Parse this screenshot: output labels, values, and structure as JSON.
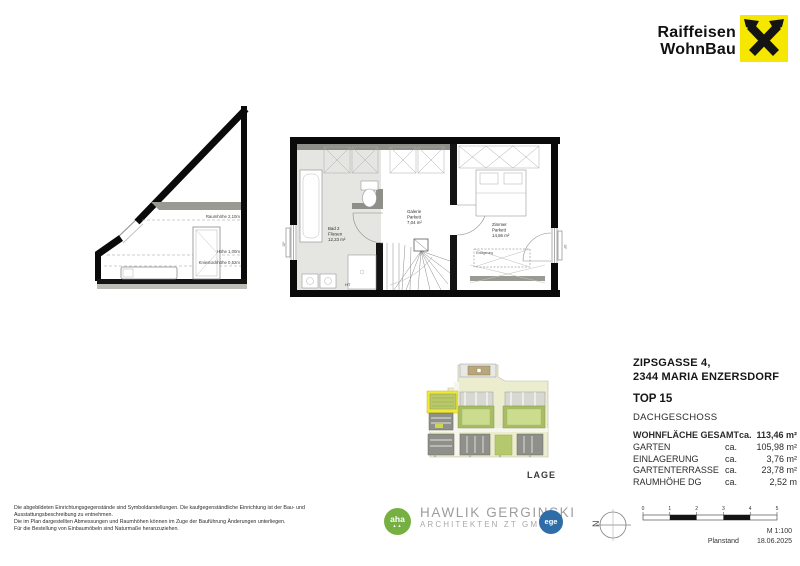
{
  "brand": {
    "name_line1": "Raiffeisen",
    "name_line2": "WohnBau"
  },
  "section_drawing": {
    "labels": {
      "room_height": "Raumhöhe 2,10m",
      "height": "Höhe 1,00m",
      "knee_wall": "Kniestockhöhe 0,52m"
    }
  },
  "floorplan": {
    "rooms": [
      {
        "name": "Bad 2",
        "finish": "Fliesen",
        "area": "12,23 m²"
      },
      {
        "name": "Galerie",
        "finish": "Parkett",
        "area": "7,04 m²"
      },
      {
        "name": "Zimmer",
        "finish": "Parkett",
        "area": "14,56 m²"
      }
    ],
    "labels": {
      "shaft": "HT",
      "storage": "Einlagerung",
      "window": "DF"
    }
  },
  "project": {
    "address_line1": "ZIPSGASSE 4,",
    "address_line2": "2344 MARIA ENZERSDORF",
    "unit": "TOP 15",
    "level": "DACHGESCHOSS",
    "areas": [
      {
        "label": "WOHNFLÄCHE GESAMT",
        "prefix": "ca.",
        "value": "113,46 m²"
      },
      {
        "label": "GARTEN",
        "prefix": "ca.",
        "value": "105,98 m²"
      },
      {
        "label": "EINLAGERUNG",
        "prefix": "ca.",
        "value": "3,76 m²"
      },
      {
        "label": "GARTENTERRASSE",
        "prefix": "ca.",
        "value": "23,78 m²"
      },
      {
        "label": "RAUMHÖHE DG",
        "prefix": "ca.",
        "value": "2,52 m"
      }
    ]
  },
  "siteplan": {
    "caption": "LAGE"
  },
  "footer": {
    "disclaimer": [
      "Die abgebildeten Einrichtungsgegenstände sind Symboldarstellungen. Die kaufgegenständliche Einrichtung ist der Bau- und",
      "Ausstattungsbeschreibung zu entnehmen.",
      "Die im Plan dargestellten Abmessungen und Raumhöhen können im Zuge der Bauführung Änderungen unterliegen.",
      "Für die Bestellung von Einbaumöbeln sind Naturmaße heranzuziehen."
    ],
    "architect": {
      "badge": "aha",
      "name": "HAWLIK GERGINSKI",
      "subtitle": "ARCHITEKTEN ZT GMBH",
      "partner_badge": "ege"
    },
    "north_label": "N",
    "scale": {
      "ticks": [
        "0",
        "1",
        "2",
        "3",
        "4",
        "5"
      ],
      "ratio": "M 1:100",
      "status_label": "Planstand",
      "date": "18.06.2025"
    }
  },
  "colors": {
    "brand_yellow": "#f6e700",
    "highlight_yellow": "#f0e832",
    "roof_green": "#a8bd62",
    "aha_green": "#76b043",
    "ege_blue": "#2f6da8"
  }
}
